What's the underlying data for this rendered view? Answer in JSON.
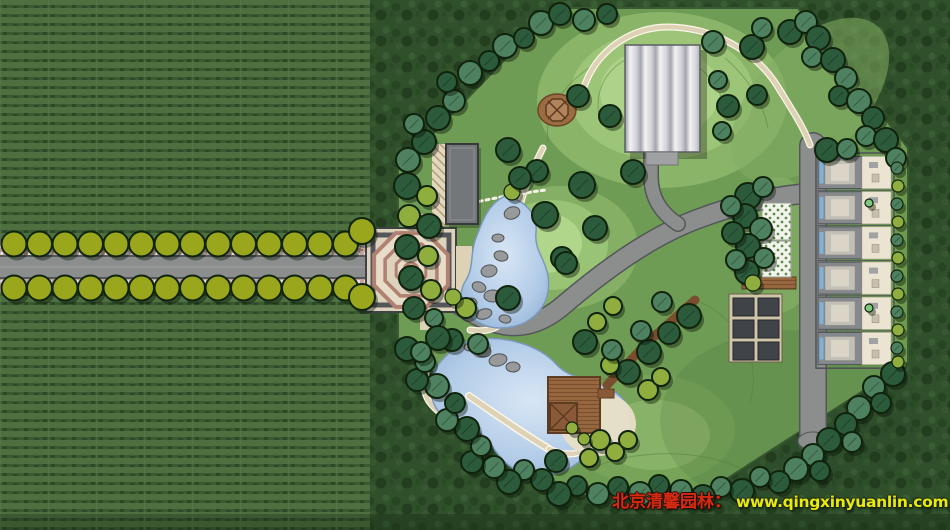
{
  "title": "park-landscape-master-plan",
  "watermark": {
    "brand_text": "北京清馨园林：",
    "site_text": "www.qingxinyuanlin.com",
    "brand_color": "#d42a12",
    "site_color": "#e6ea0e"
  },
  "palette": {
    "wm_brand": "#d42a12",
    "wm_site": "#e6ea0e",
    "field": "#4e7040",
    "forest": "#30502c",
    "park_lawn": "#6f9c55",
    "road": "#8b8e8c",
    "road_edge": "#54575a",
    "path_tan": "#ddd2b5",
    "path_light": "#fbf6e8",
    "pond": "#a6c3e2",
    "outline": "#10230d",
    "tree_dark": "#2c5b3c",
    "tree_mid": "#4e8160",
    "tree_yellow": "#8fae3e",
    "tree_light": "#7fc97f",
    "avenue_tree": "#9aa61c",
    "plaza_fill": "#ddd3bd",
    "plaza_ring": "#b08070",
    "deck_brown": "#8a5a38",
    "deck_dark": "#5e3c22",
    "rock": "#97999b",
    "roof_gray": "#85888d",
    "court_cream": "#ece4d2",
    "court_blue": "#7fb2d8",
    "hedge": "#6d9a4c"
  },
  "avenue": {
    "start_x": 14,
    "spacing": 25.5,
    "tree_radius": 12.5,
    "rows": [
      {
        "y": 244,
        "count": 14
      },
      {
        "y": 288,
        "count": 14
      }
    ],
    "corner_trees": [
      [
        362,
        231,
        13
      ],
      [
        362,
        297,
        13
      ]
    ]
  },
  "townhouses": {
    "x": 818,
    "top": 155,
    "unit_h": 35.2,
    "count": 6
  },
  "pergola": {
    "rows": 3,
    "cols": 2
  },
  "park_trees": [
    [
      408,
      160,
      12,
      "m"
    ],
    [
      424,
      142,
      12,
      "d"
    ],
    [
      414,
      124,
      10,
      "m"
    ],
    [
      438,
      118,
      12,
      "d"
    ],
    [
      454,
      101,
      11,
      "m"
    ],
    [
      447,
      82,
      10,
      "d"
    ],
    [
      470,
      73,
      12,
      "m"
    ],
    [
      489,
      61,
      10,
      "d"
    ],
    [
      505,
      46,
      12,
      "m"
    ],
    [
      524,
      38,
      10,
      "d"
    ],
    [
      541,
      23,
      12,
      "m"
    ],
    [
      560,
      14,
      11,
      "d"
    ],
    [
      584,
      20,
      11,
      "m"
    ],
    [
      607,
      14,
      10,
      "d"
    ],
    [
      713,
      42,
      11,
      "m"
    ],
    [
      752,
      47,
      12,
      "d"
    ],
    [
      762,
      28,
      10,
      "m"
    ],
    [
      790,
      32,
      12,
      "d"
    ],
    [
      806,
      22,
      11,
      "m"
    ],
    [
      818,
      38,
      12,
      "d"
    ],
    [
      812,
      57,
      10,
      "m"
    ],
    [
      833,
      60,
      12,
      "d"
    ],
    [
      846,
      78,
      11,
      "m"
    ],
    [
      839,
      96,
      10,
      "d"
    ],
    [
      859,
      101,
      12,
      "m"
    ],
    [
      873,
      118,
      11,
      "d"
    ],
    [
      866,
      136,
      10,
      "m"
    ],
    [
      886,
      140,
      12,
      "d"
    ],
    [
      896,
      158,
      10,
      "m"
    ],
    [
      827,
      150,
      12,
      "d"
    ],
    [
      847,
      149,
      10,
      "m"
    ],
    [
      893,
      374,
      12,
      "d"
    ],
    [
      874,
      387,
      11,
      "m"
    ],
    [
      881,
      403,
      10,
      "d"
    ],
    [
      859,
      408,
      12,
      "m"
    ],
    [
      846,
      424,
      11,
      "d"
    ],
    [
      852,
      442,
      10,
      "m"
    ],
    [
      829,
      440,
      12,
      "d"
    ],
    [
      813,
      455,
      11,
      "m"
    ],
    [
      820,
      471,
      10,
      "d"
    ],
    [
      796,
      469,
      12,
      "m"
    ],
    [
      779,
      482,
      11,
      "d"
    ],
    [
      760,
      477,
      10,
      "m"
    ],
    [
      742,
      491,
      12,
      "d"
    ],
    [
      721,
      487,
      10,
      "m"
    ],
    [
      703,
      497,
      12,
      "d"
    ],
    [
      681,
      491,
      11,
      "m"
    ],
    [
      659,
      485,
      10,
      "d"
    ],
    [
      640,
      494,
      12,
      "m"
    ],
    [
      618,
      487,
      10,
      "d"
    ],
    [
      598,
      494,
      11,
      "m"
    ],
    [
      577,
      486,
      10,
      "d"
    ],
    [
      559,
      494,
      12,
      "d"
    ],
    [
      542,
      480,
      11,
      "d"
    ],
    [
      524,
      470,
      10,
      "m"
    ],
    [
      509,
      482,
      12,
      "d"
    ],
    [
      494,
      467,
      11,
      "m"
    ],
    [
      472,
      462,
      11,
      "d"
    ],
    [
      481,
      446,
      10,
      "m"
    ],
    [
      467,
      429,
      12,
      "d"
    ],
    [
      447,
      420,
      11,
      "m"
    ],
    [
      455,
      403,
      10,
      "d"
    ],
    [
      437,
      386,
      12,
      "m"
    ],
    [
      417,
      380,
      11,
      "d"
    ],
    [
      425,
      362,
      10,
      "m"
    ],
    [
      407,
      349,
      12,
      "d"
    ],
    [
      407,
      186,
      13,
      "d"
    ],
    [
      427,
      196,
      10,
      "y"
    ],
    [
      409,
      216,
      11,
      "y"
    ],
    [
      429,
      226,
      12,
      "d"
    ],
    [
      407,
      247,
      12,
      "d"
    ],
    [
      428,
      256,
      10,
      "y"
    ],
    [
      411,
      278,
      12,
      "d"
    ],
    [
      431,
      290,
      10,
      "y"
    ],
    [
      414,
      308,
      11,
      "d"
    ],
    [
      434,
      318,
      9,
      "m"
    ],
    [
      452,
      340,
      11,
      "d"
    ],
    [
      478,
      344,
      10,
      "m"
    ],
    [
      466,
      308,
      10,
      "y"
    ],
    [
      610,
      116,
      11,
      "d"
    ],
    [
      728,
      106,
      11,
      "d"
    ],
    [
      722,
      131,
      9,
      "m"
    ],
    [
      757,
      95,
      10,
      "d"
    ],
    [
      718,
      80,
      9,
      "m"
    ],
    [
      578,
      96,
      11,
      "d"
    ],
    [
      508,
      150,
      12,
      "d"
    ],
    [
      537,
      171,
      11,
      "d"
    ],
    [
      582,
      185,
      13,
      "d"
    ],
    [
      633,
      172,
      12,
      "d"
    ],
    [
      595,
      228,
      12,
      "d"
    ],
    [
      562,
      258,
      11,
      "d"
    ],
    [
      545,
      215,
      13,
      "d"
    ],
    [
      566,
      263,
      11,
      "d"
    ],
    [
      508,
      298,
      12,
      "d"
    ],
    [
      512,
      192,
      8,
      "y"
    ],
    [
      453,
      297,
      8,
      "y"
    ],
    [
      520,
      178,
      11,
      "d"
    ],
    [
      748,
      196,
      13,
      "d"
    ],
    [
      763,
      187,
      10,
      "m"
    ],
    [
      745,
      216,
      12,
      "d"
    ],
    [
      761,
      229,
      11,
      "m"
    ],
    [
      748,
      246,
      12,
      "d"
    ],
    [
      764,
      258,
      10,
      "m"
    ],
    [
      747,
      272,
      12,
      "d"
    ],
    [
      731,
      206,
      10,
      "m"
    ],
    [
      733,
      233,
      11,
      "d"
    ],
    [
      736,
      260,
      10,
      "m"
    ],
    [
      753,
      283,
      8,
      "y"
    ],
    [
      628,
      372,
      12,
      "d"
    ],
    [
      649,
      352,
      12,
      "d"
    ],
    [
      669,
      333,
      11,
      "d"
    ],
    [
      689,
      316,
      12,
      "d"
    ],
    [
      641,
      331,
      10,
      "m"
    ],
    [
      610,
      365,
      9,
      "y"
    ],
    [
      597,
      322,
      9,
      "y"
    ],
    [
      613,
      306,
      9,
      "y"
    ],
    [
      662,
      302,
      10,
      "m"
    ],
    [
      438,
      338,
      12,
      "d"
    ],
    [
      421,
      352,
      10,
      "m"
    ],
    [
      585,
      342,
      12,
      "d"
    ],
    [
      612,
      350,
      10,
      "m"
    ],
    [
      600,
      440,
      10,
      "y"
    ],
    [
      615,
      452,
      9,
      "y"
    ],
    [
      628,
      440,
      9,
      "y"
    ],
    [
      589,
      458,
      9,
      "y"
    ],
    [
      556,
      461,
      11,
      "d"
    ],
    [
      648,
      390,
      10,
      "y"
    ],
    [
      661,
      377,
      9,
      "y"
    ],
    [
      572,
      428,
      6,
      "y"
    ],
    [
      584,
      439,
      6,
      "y"
    ],
    [
      897,
      168,
      6,
      "m"
    ],
    [
      898,
      186,
      6,
      "y"
    ],
    [
      897,
      204,
      6,
      "m"
    ],
    [
      898,
      222,
      6,
      "y"
    ],
    [
      897,
      240,
      6,
      "m"
    ],
    [
      898,
      258,
      6,
      "y"
    ],
    [
      897,
      276,
      6,
      "m"
    ],
    [
      898,
      294,
      6,
      "y"
    ],
    [
      897,
      312,
      6,
      "m"
    ],
    [
      898,
      330,
      6,
      "y"
    ],
    [
      897,
      348,
      6,
      "m"
    ],
    [
      898,
      362,
      6,
      "y"
    ],
    [
      869,
      203,
      4,
      "l"
    ],
    [
      869,
      308,
      4,
      "l"
    ]
  ]
}
